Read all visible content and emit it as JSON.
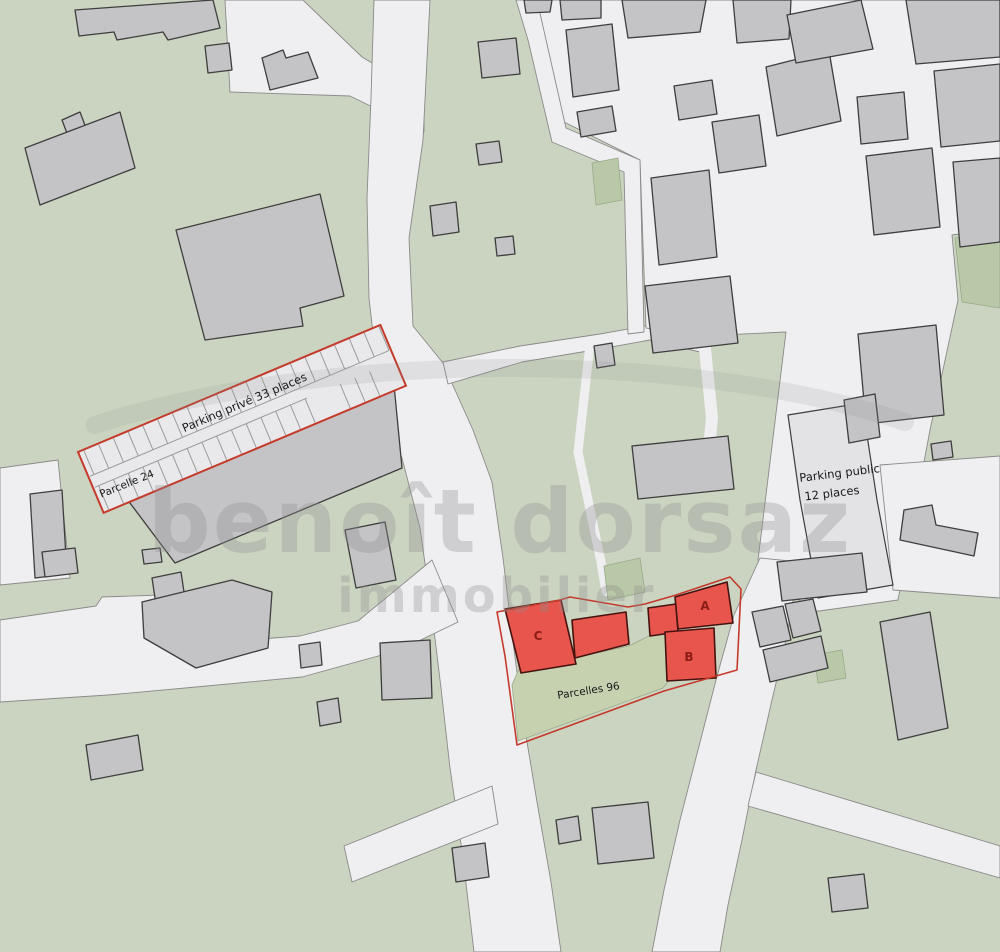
{
  "map": {
    "labels": {
      "parking_prive": "Parking privé 33 places",
      "parcelle_24": "Parcelle 24",
      "parking_public_line1": "Parking public",
      "parking_public_line2": "12 places",
      "parcelles_96": "Parcelles 96"
    },
    "buildings": {
      "a": "A",
      "b": "B",
      "c": "C"
    },
    "watermark": {
      "line1": "benoît dorsaz",
      "line2": "immobilier"
    },
    "colors": {
      "background_green": "#cbd4c0",
      "parcel_green": "#c6d1b0",
      "accent_green": "#b9c8a6",
      "road": "#efeff1",
      "road_border": "#8a8a8a",
      "building_gray": "#c4c4c7",
      "building_border": "#3e3e3e",
      "building_light": "#e3e3e6",
      "red_fill": "#e8554c",
      "red_dark_border": "#46120f",
      "red_outline": "#c43b2c",
      "letter_color": "#8c1c16",
      "label_color": "#1a1a1a",
      "watermark_gray": "#8f8f8f"
    }
  }
}
